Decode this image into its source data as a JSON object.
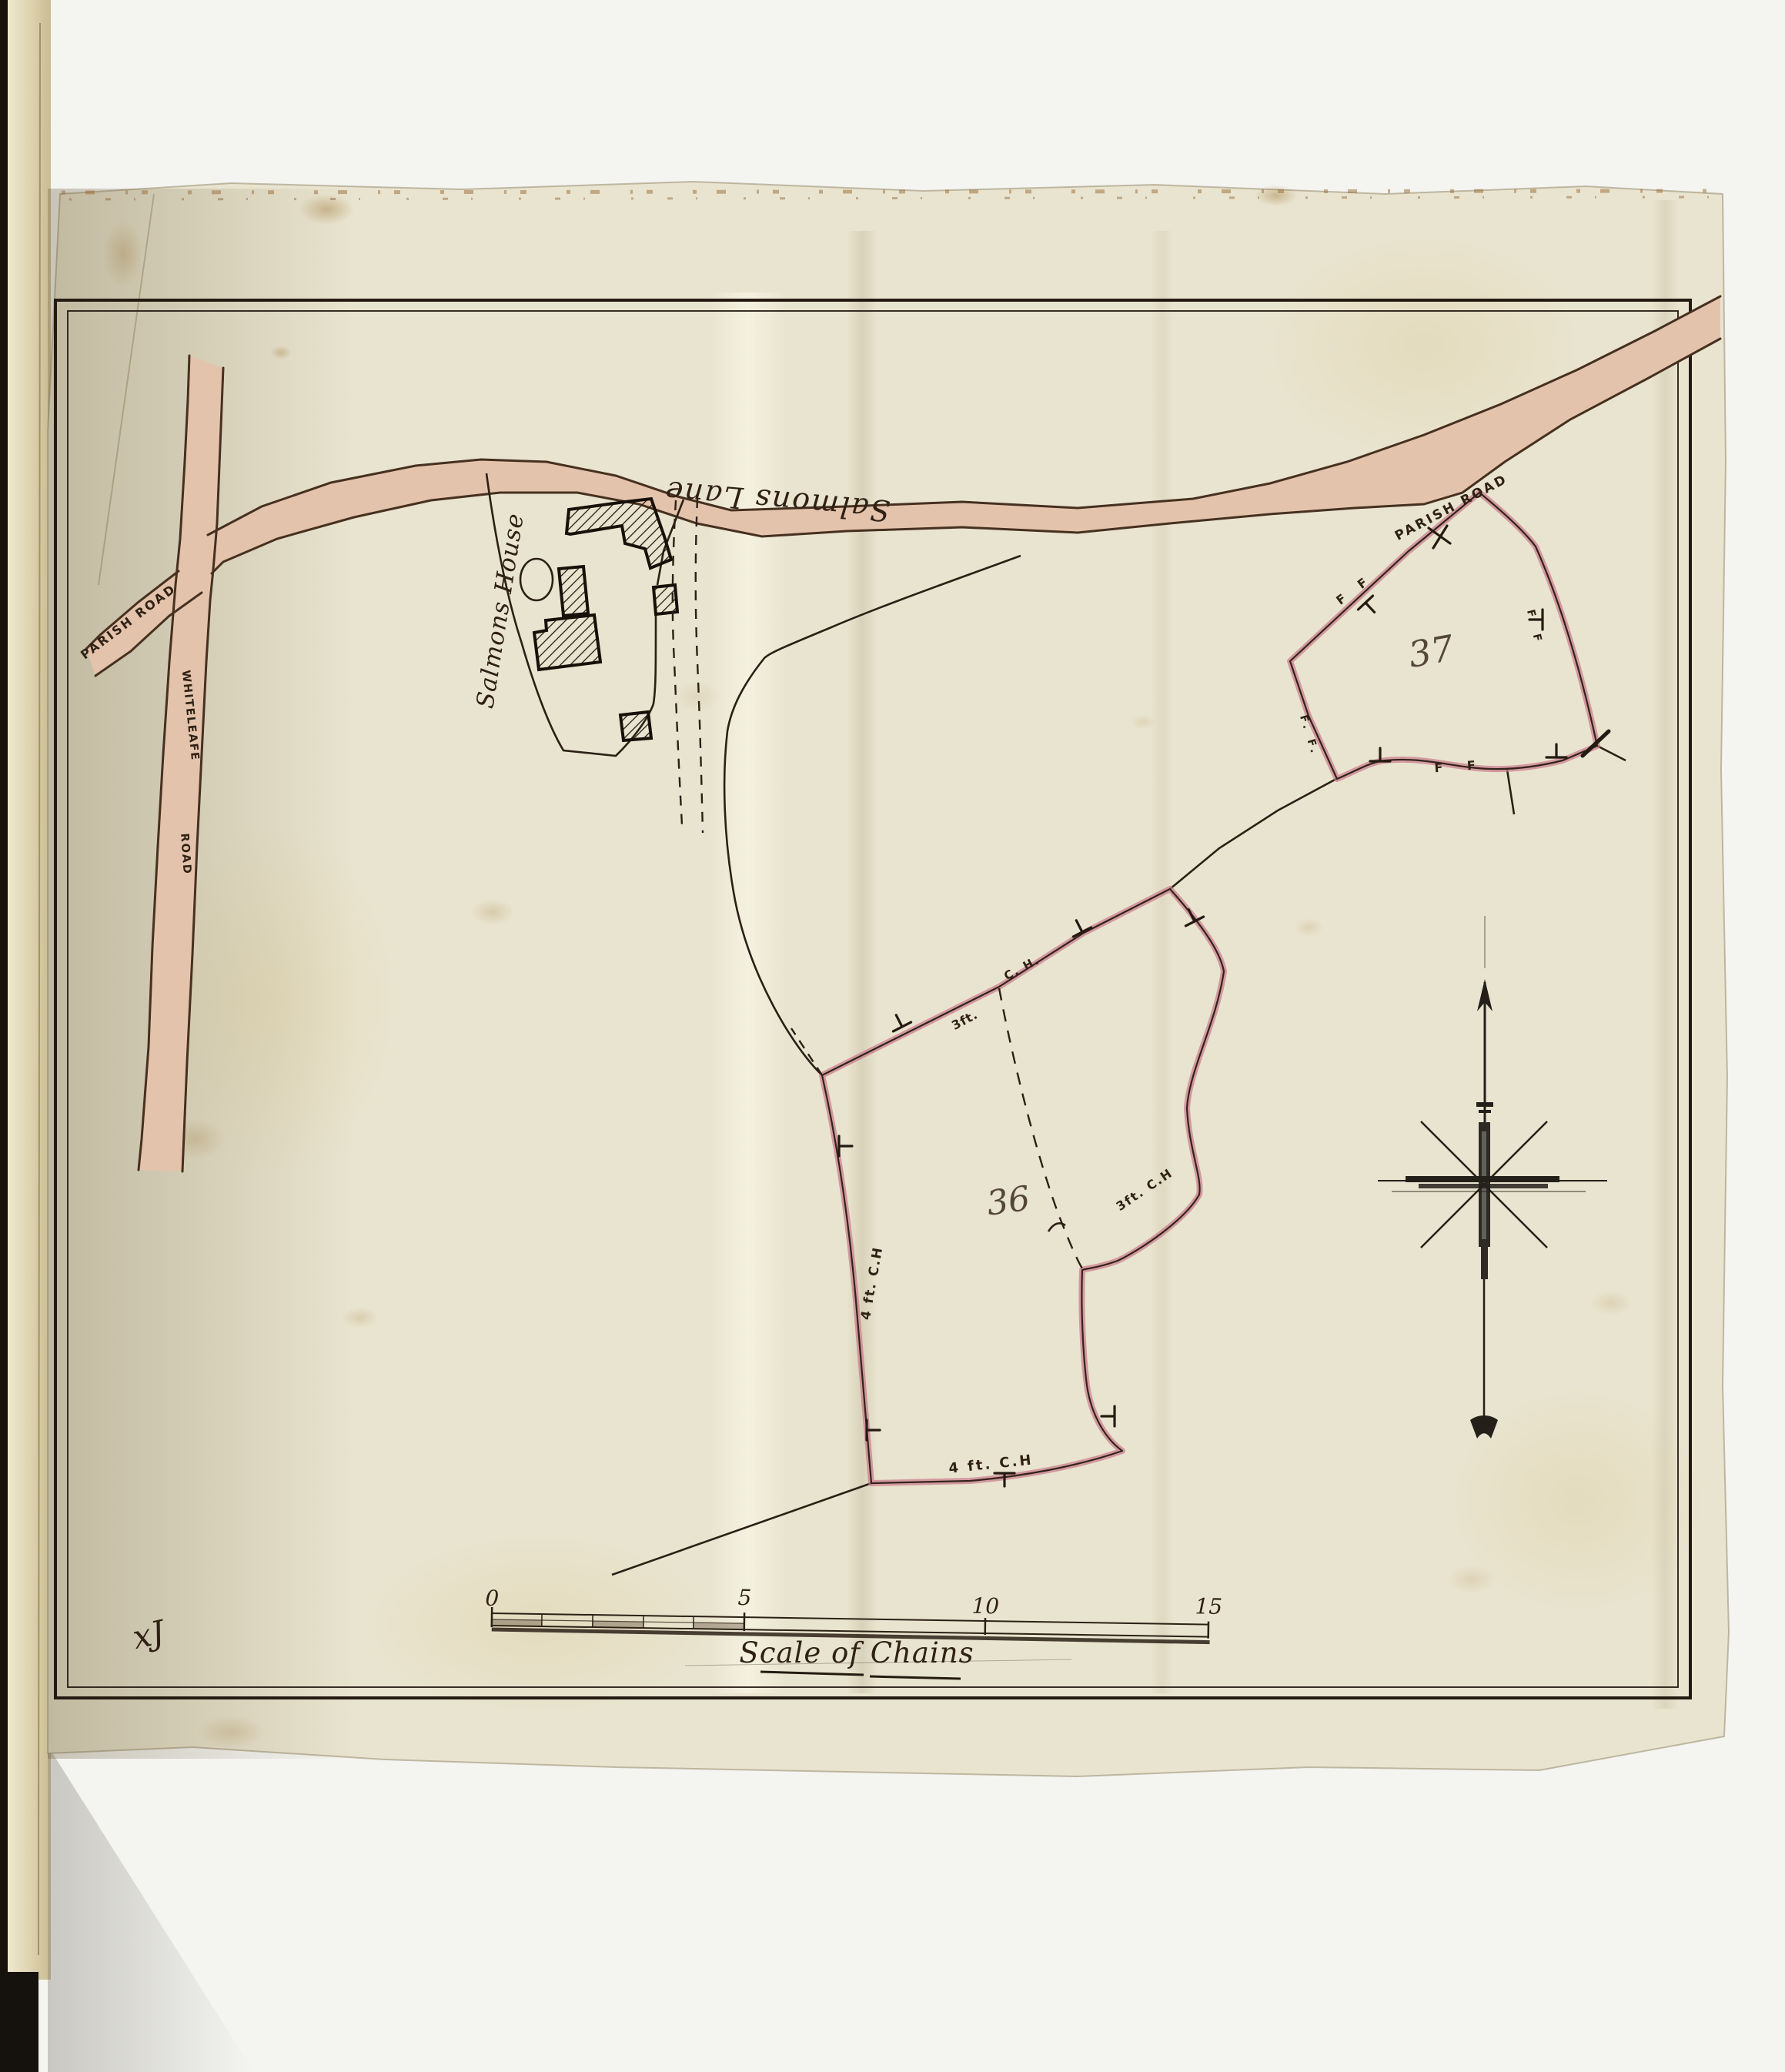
{
  "document": {
    "type": "hand-drawn estate plan, scanned bound volume page",
    "scale": {
      "title": "Scale of Chains",
      "t0": "0",
      "t5": "5",
      "t10": "10",
      "t15": "15"
    },
    "surveyor_mark": "xJ"
  },
  "roads": {
    "salmons_lane": "Salmons Lane",
    "whiteleafe_1": "WHITELEAFE",
    "whiteleafe_2": "ROAD",
    "parish_west": "PARISH ROAD",
    "parish_east": "PARISH ROAD"
  },
  "features": {
    "house": "Salmons House"
  },
  "parcels": {
    "p37": {
      "number": "37",
      "mark_nw": "F F",
      "mark_sw": "F. F.",
      "mark_e": "F F",
      "mark_s": "F F"
    },
    "p36": {
      "number": "36",
      "hedge_top_left": "3ft.",
      "hedge_top_right": "C. H.",
      "hedge_east": "3ft. C.H",
      "hedge_west": "4 ft. C.H",
      "hedge_south": "4 ft. C.H"
    }
  },
  "colors": {
    "paper": "#e9e4cf",
    "backing_white": "#f4f4f1",
    "ink": "#2b2015",
    "road_fill": "#e4c3ac",
    "parcel_pink": "#c9798c",
    "pencil": "#8d8672"
  }
}
